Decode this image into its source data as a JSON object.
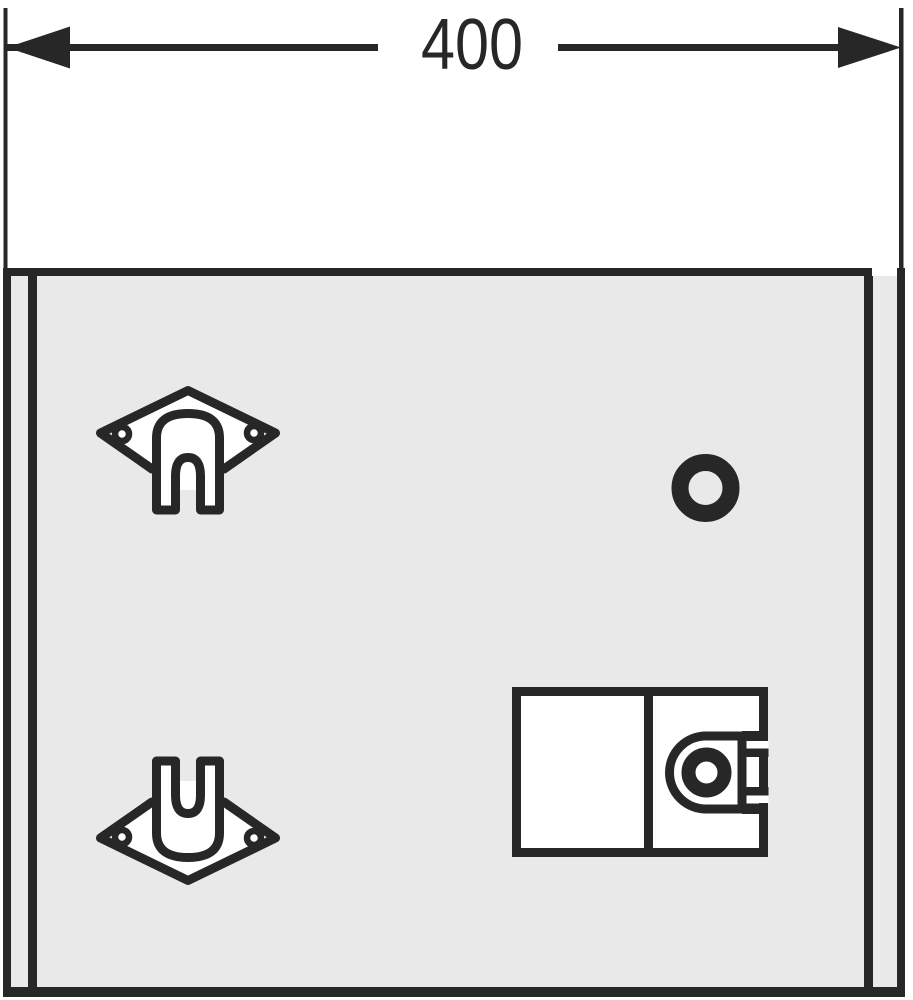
{
  "drawing": {
    "kind": "technical-dimension-drawing-front-view",
    "dimension": {
      "label": "400",
      "orientation": "horizontal",
      "position": "top"
    },
    "colors": {
      "line": "#272727",
      "panel": "#e9e9e9",
      "paper": "#ffffff",
      "bg": "#ffffff"
    },
    "components": {
      "panel": "cabinet-front-panel",
      "bracket_top": "wall-mounting-bracket-upper",
      "bracket_bottom": "wall-mounting-bracket-lower",
      "hole": "round-drill-hole",
      "lock": "lock-box-with-latch-keeper"
    }
  }
}
